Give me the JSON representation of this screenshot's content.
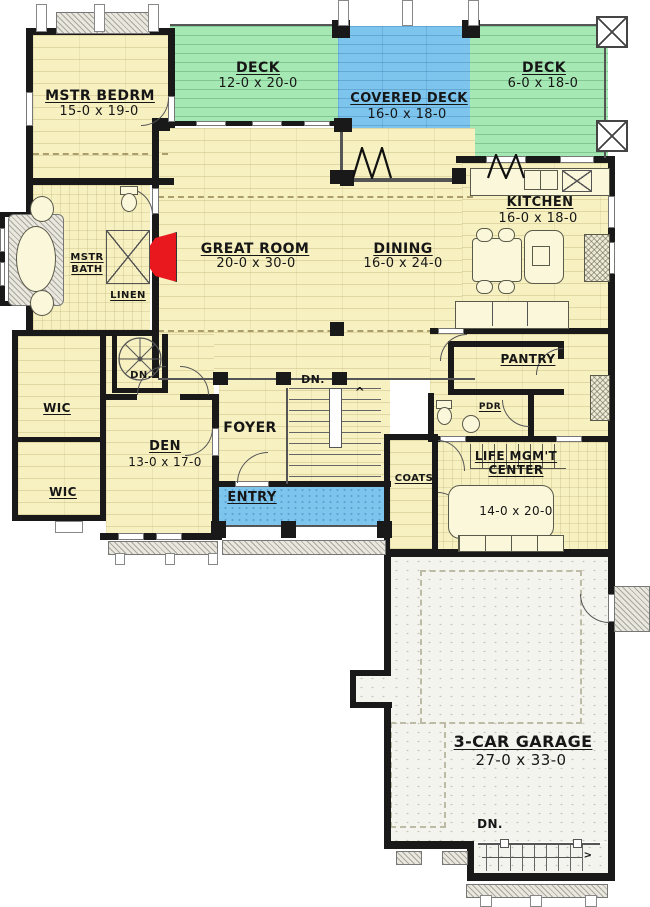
{
  "colors": {
    "wall": "#191919",
    "floor_cream": "#F7F1C2",
    "deck_green": "#A6E8B4",
    "deck_blue": "#7EC5EE",
    "garage_floor": "#F4F4EF",
    "fireplace_red": "#E8181E"
  },
  "rooms": {
    "mstr_bedrm": {
      "name": "MSTR BEDRM",
      "dims": "15-0 x 19-0"
    },
    "deck_left": {
      "name": "DECK",
      "dims": "12-0 x 20-0"
    },
    "covered_deck": {
      "name": "COVERED DECK",
      "dims": "16-0 x 18-0"
    },
    "deck_right": {
      "name": "DECK",
      "dims": "6-0 x 18-0"
    },
    "great_room": {
      "name": "GREAT ROOM",
      "dims": "20-0 x 30-0"
    },
    "dining": {
      "name": "DINING",
      "dims": "16-0 x 24-0"
    },
    "kitchen": {
      "name": "KITCHEN",
      "dims": "16-0 x 18-0"
    },
    "mstr_bath": {
      "name": "MSTR BATH"
    },
    "linen": {
      "name": "LINEN"
    },
    "wic_upper": {
      "name": "WIC"
    },
    "wic_lower": {
      "name": "WIC"
    },
    "den": {
      "name": "DEN",
      "dims": "13-0 x 17-0"
    },
    "foyer": {
      "name": "FOYER"
    },
    "entry": {
      "name": "ENTRY"
    },
    "coats": {
      "name": "COATS"
    },
    "pantry": {
      "name": "PANTRY"
    },
    "pdr": {
      "name": "PDR"
    },
    "life_mgmt": {
      "line1": "LIFE MGM'T",
      "line2": "CENTER",
      "dims": "14-0 x 20-0"
    },
    "garage": {
      "name": "3-CAR GARAGE",
      "dims": "27-0 x 33-0"
    }
  },
  "annotations": {
    "dn_spiral": "DN.",
    "dn_stairs": "DN.",
    "dn_garage": "DN.",
    "up_arrow": "^",
    "right_arrow": ">"
  }
}
